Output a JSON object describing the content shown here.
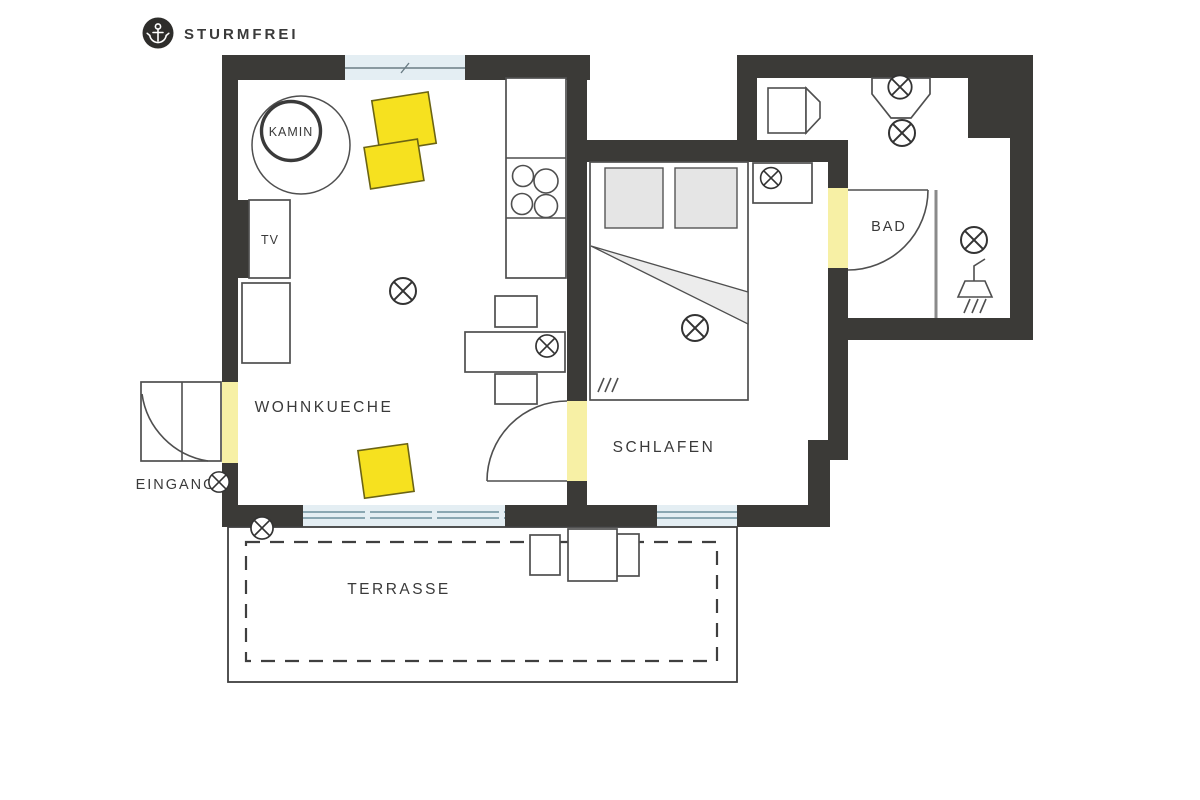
{
  "header": {
    "brand": "STURMFREI",
    "logo_icon": "anchor-icon"
  },
  "floorplan": {
    "rooms": {
      "wohnkueche": "WOHNKUECHE",
      "schlafen": "SCHLAFEN",
      "bad": "BAD",
      "eingang": "EINGANG",
      "terrasse": "TERRASSE"
    },
    "features": {
      "kamin": "KAMIN",
      "tv": "TV"
    },
    "icons": {
      "logo": "anchor-icon",
      "light": "ceiling-light-icon",
      "shower": "shower-head-icon"
    },
    "counts": {
      "ceiling_lights": 9
    },
    "colors": {
      "wall": "#3b3a37",
      "door_opening": "#f7f0a5",
      "furniture_yellow": "#f6e11f",
      "furniture_yellow_border": "#6b6414",
      "window_fill": "#e4eef3",
      "window_line": "#8aa7b2",
      "outline": "#4f4f4f",
      "text": "#3a3a3a",
      "logo_circle": "#2e2d2b",
      "background": "#ffffff"
    }
  }
}
